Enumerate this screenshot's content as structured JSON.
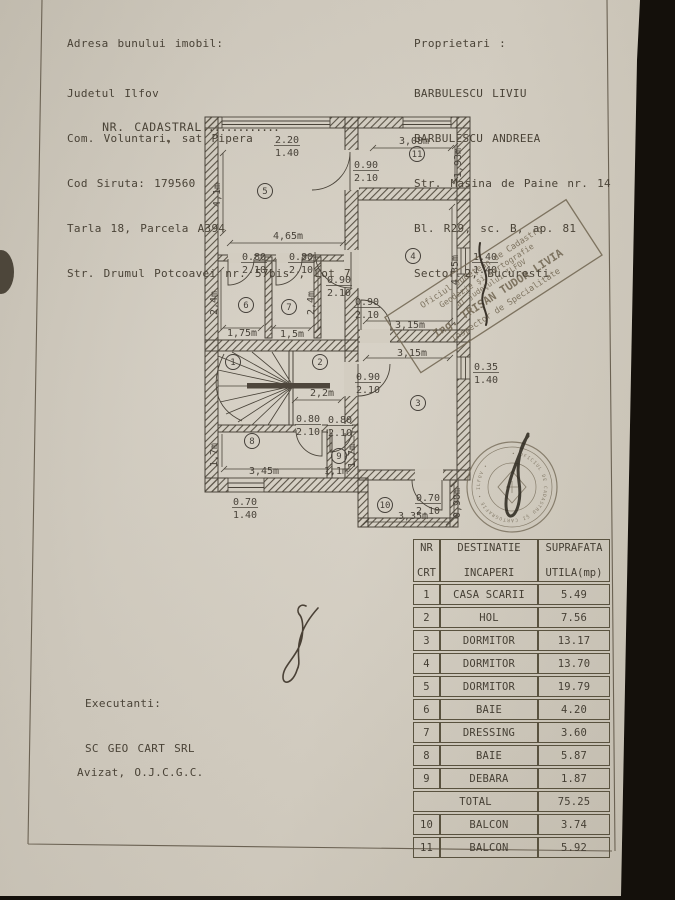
{
  "address_block": {
    "title": "Adresa bunului imobil:",
    "lines": [
      "Judetul Ilfov",
      "Com. Voluntari, sat Pipera",
      "Cod Siruta: 179560",
      "Tarla 18, Parcela A394",
      "Str. Drumul Potcoavei nr. 57bis , Lot 7"
    ]
  },
  "cadastral": {
    "label": "NR. CADASTRAL",
    "dots": "............."
  },
  "owners_block": {
    "title": "Proprietari :",
    "lines": [
      "BARBULESCU LIVIU",
      "BARBULESCU ANDREEA",
      "Str. Masina de Paine nr. 14",
      "Bl. R29, sc. B, ap. 81",
      "Sector 2, Bucuresti"
    ]
  },
  "plan": {
    "rooms": [
      {
        "n": "1",
        "x": 233,
        "y": 365
      },
      {
        "n": "2",
        "x": 320,
        "y": 365
      },
      {
        "n": "3",
        "x": 418,
        "y": 406
      },
      {
        "n": "4",
        "x": 413,
        "y": 259
      },
      {
        "n": "5",
        "x": 265,
        "y": 194
      },
      {
        "n": "6",
        "x": 246,
        "y": 308
      },
      {
        "n": "7",
        "x": 289,
        "y": 310
      },
      {
        "n": "8",
        "x": 252,
        "y": 444
      },
      {
        "n": "9",
        "x": 339,
        "y": 459
      },
      {
        "n": "10",
        "x": 385,
        "y": 508
      },
      {
        "n": "11",
        "x": 417,
        "y": 157
      }
    ],
    "dims": [
      {
        "t": "3,08m",
        "x": 414,
        "y": 144
      },
      {
        "t": "4,65m",
        "x": 288,
        "y": 239
      },
      {
        "t": "1,75m",
        "x": 242,
        "y": 336
      },
      {
        "t": "1,5m",
        "x": 292,
        "y": 337
      },
      {
        "t": "3,15m",
        "x": 410,
        "y": 328
      },
      {
        "t": "3,15m",
        "x": 412,
        "y": 356
      },
      {
        "t": "2,2m",
        "x": 322,
        "y": 396
      },
      {
        "t": "3,45m",
        "x": 264,
        "y": 474
      },
      {
        "t": "1,1m",
        "x": 336,
        "y": 474
      },
      {
        "t": "3,35m",
        "x": 413,
        "y": 519
      }
    ],
    "dims_rot": [
      {
        "t": "4,1m",
        "x": 220,
        "y": 195
      },
      {
        "t": "1,93m",
        "x": 461,
        "y": 163
      },
      {
        "t": "2,4m",
        "x": 217,
        "y": 303
      },
      {
        "t": "2,4m",
        "x": 314,
        "y": 303
      },
      {
        "t": "4,35m",
        "x": 458,
        "y": 270
      },
      {
        "t": "1,7m",
        "x": 217,
        "y": 455
      },
      {
        "t": "1,7m",
        "x": 355,
        "y": 456
      },
      {
        "t": "0,90m",
        "x": 460,
        "y": 503
      }
    ],
    "fractions": [
      {
        "top": "2.20",
        "bottom": "1.40",
        "x": 287,
        "y": 143
      },
      {
        "top": "0.90",
        "bottom": "2.10",
        "x": 366,
        "y": 168
      },
      {
        "top": "0.80",
        "bottom": "2.10",
        "x": 254,
        "y": 260
      },
      {
        "top": "0.80",
        "bottom": "2.10",
        "x": 301,
        "y": 260
      },
      {
        "top": "0.90",
        "bottom": "2.10",
        "x": 339,
        "y": 283
      },
      {
        "top": "0.90",
        "bottom": "2.10",
        "x": 367,
        "y": 305
      },
      {
        "top": "1.40",
        "bottom": "1.40",
        "x": 485,
        "y": 260
      },
      {
        "top": "0.90",
        "bottom": "2.10",
        "x": 368,
        "y": 380
      },
      {
        "top": "0.35",
        "bottom": "1.40",
        "x": 486,
        "y": 370
      },
      {
        "top": "0.80",
        "bottom": "2.10",
        "x": 308,
        "y": 422
      },
      {
        "top": "0.80",
        "bottom": "2.10",
        "x": 340,
        "y": 423
      },
      {
        "top": "0.70",
        "bottom": "1.40",
        "x": 245,
        "y": 505
      },
      {
        "top": "0.70",
        "bottom": "2.10",
        "x": 428,
        "y": 501
      }
    ]
  },
  "stamps": {
    "diagonal": {
      "lines": [
        "Oficiul Judeţean de Cadastru",
        "Geodezie şi Cartografie",
        "al judeţului ILFOV",
        "Ing. TRIŞAN TUDOR LIVIA",
        "Inspector de Specialitate"
      ]
    },
    "round": {
      "ring_text": "• OFICIUL DE CADASTRU ŞI CARTOGRAFIE • ILFOV •"
    }
  },
  "table": {
    "headers": [
      [
        "NR",
        "CRT"
      ],
      [
        "DESTINATIE",
        "INCAPERI"
      ],
      [
        "SUPRAFATA",
        "UTILA(mp)"
      ]
    ],
    "rows": [
      {
        "no": "1",
        "name": "CASA SCARII",
        "area": "5.49"
      },
      {
        "no": "2",
        "name": "HOL",
        "area": "7.56"
      },
      {
        "no": "3",
        "name": "DORMITOR",
        "area": "13.17"
      },
      {
        "no": "4",
        "name": "DORMITOR",
        "area": "13.70"
      },
      {
        "no": "5",
        "name": "DORMITOR",
        "area": "19.79"
      },
      {
        "no": "6",
        "name": "BAIE",
        "area": "4.20"
      },
      {
        "no": "7",
        "name": "DRESSING",
        "area": "3.60"
      },
      {
        "no": "8",
        "name": "BAIE",
        "area": "5.87"
      },
      {
        "no": "9",
        "name": "DEBARA",
        "area": "1.87"
      },
      {
        "no": "",
        "name": "TOTAL",
        "area": "75.25",
        "total": true
      },
      {
        "no": "10",
        "name": "BALCON",
        "area": "3.74"
      },
      {
        "no": "11",
        "name": "BALCON",
        "area": "5.92"
      }
    ]
  },
  "footer": {
    "executant_title": "Executanti:",
    "executant_name": "SC GEO CART SRL",
    "avizat": "Avizat, O.J.C.G.C."
  }
}
